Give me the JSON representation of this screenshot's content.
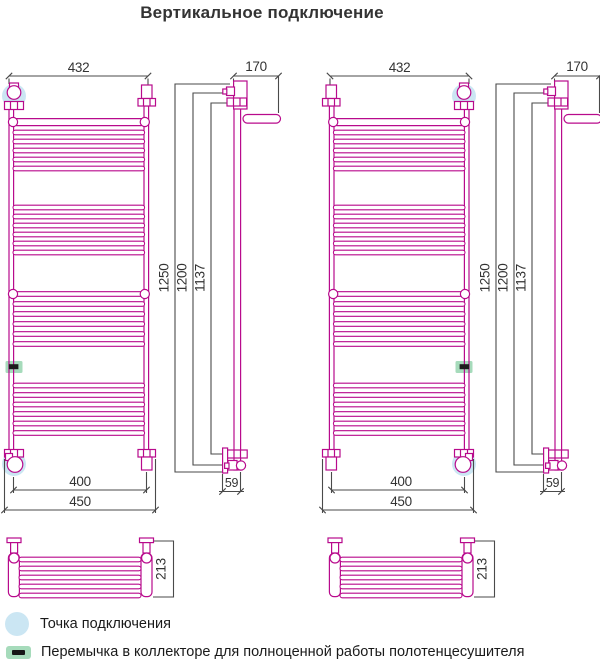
{
  "title": "Вертикальное подключение",
  "dimensions": {
    "top_width": "432",
    "pipe_spacing": "400",
    "overall_width": "450",
    "wall_depth": "170",
    "bottom_offset": "59",
    "overall_height": "1250",
    "tube_height": "1200",
    "axis_height": "1137",
    "shelf_depth": "213"
  },
  "legend": {
    "items": [
      {
        "label": "Точка подключения"
      },
      {
        "label": "Перемычка в коллекторе для полноценной работы полотенцесушителя"
      }
    ]
  },
  "colors": {
    "drawing": "#b80a8c",
    "dimension_lines": "#4a4a4a",
    "connection_highlight": "#cbe6f3",
    "jumper_highlight": "#a6dbbb"
  }
}
